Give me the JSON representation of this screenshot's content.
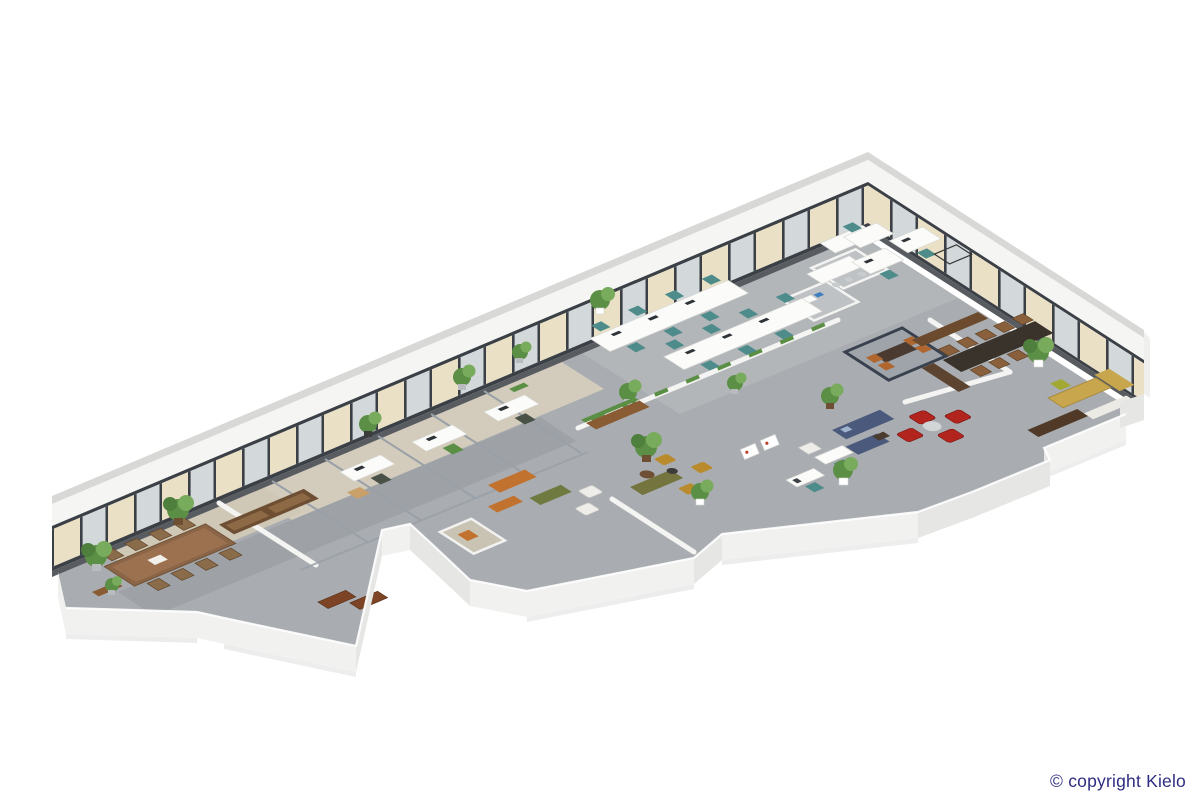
{
  "footer": {
    "copyright": "© copyright Kielo"
  },
  "colors": {
    "background": "#ffffff",
    "copyright_text": "#2e2d82",
    "floor_main": "#a9adb1",
    "floor_room_beige": "#d5cebd",
    "floor_corridor": "#9b9fa3",
    "wall_white": "#f2f2f0",
    "wall_outer_lip": "#d8d8d6",
    "window_frame": "#3b4046",
    "window_blind_beige": "#e9e0c5",
    "window_glass": "#d3d8db",
    "sofa_orange": "#c2722f",
    "sofa_olive": "#74743f",
    "sofa_navy": "#4b5a7c",
    "sofa_leather_brown": "#7c4424",
    "armchair_red": "#b2241e",
    "chair_teal": "#4e8b8b",
    "chair_mustard": "#b98b2c",
    "table_wood": "#8a6547",
    "table_dark": "#3a332c",
    "desk_exec_tan": "#c7a64e",
    "plant_green": "#5c8f46"
  }
}
